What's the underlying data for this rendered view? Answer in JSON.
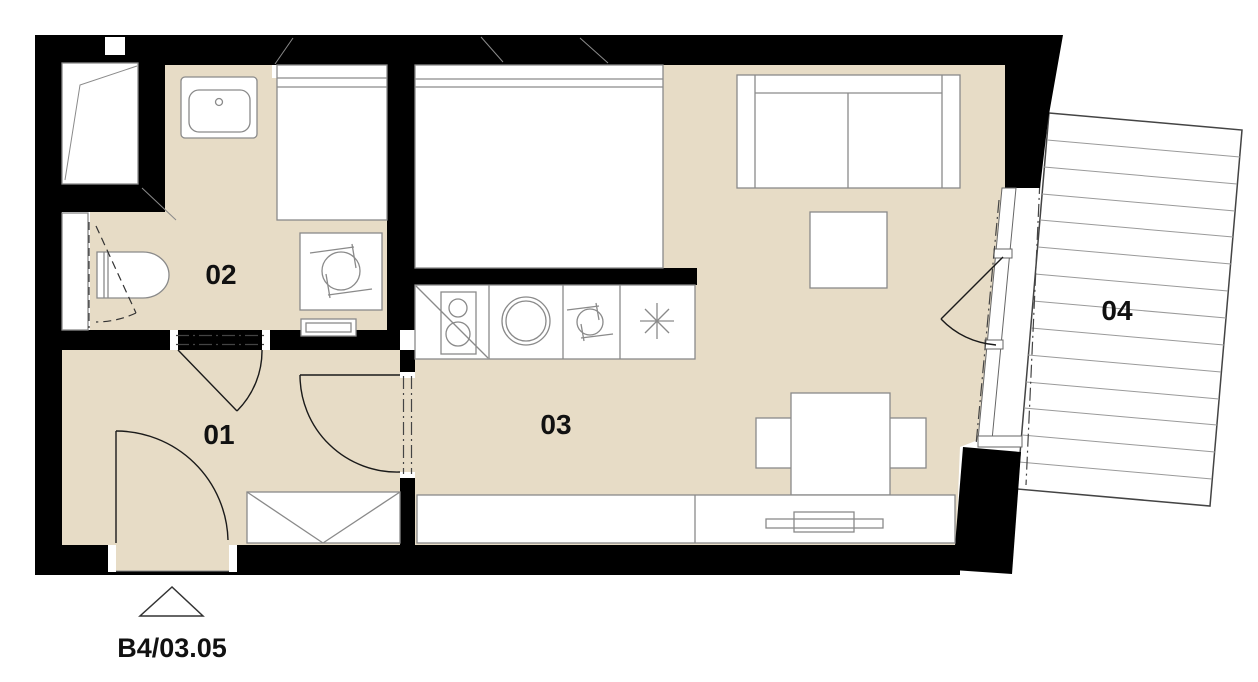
{
  "floorplan": {
    "unit_label": "B4/03.05",
    "rooms": [
      {
        "id": "01",
        "label": "01"
      },
      {
        "id": "02",
        "label": "02"
      },
      {
        "id": "03",
        "label": "03"
      },
      {
        "id": "04",
        "label": "04"
      }
    ],
    "colors": {
      "floor": "#E7DCC6",
      "wall": "#000000",
      "furniture_line": "#8A8A8A"
    }
  }
}
